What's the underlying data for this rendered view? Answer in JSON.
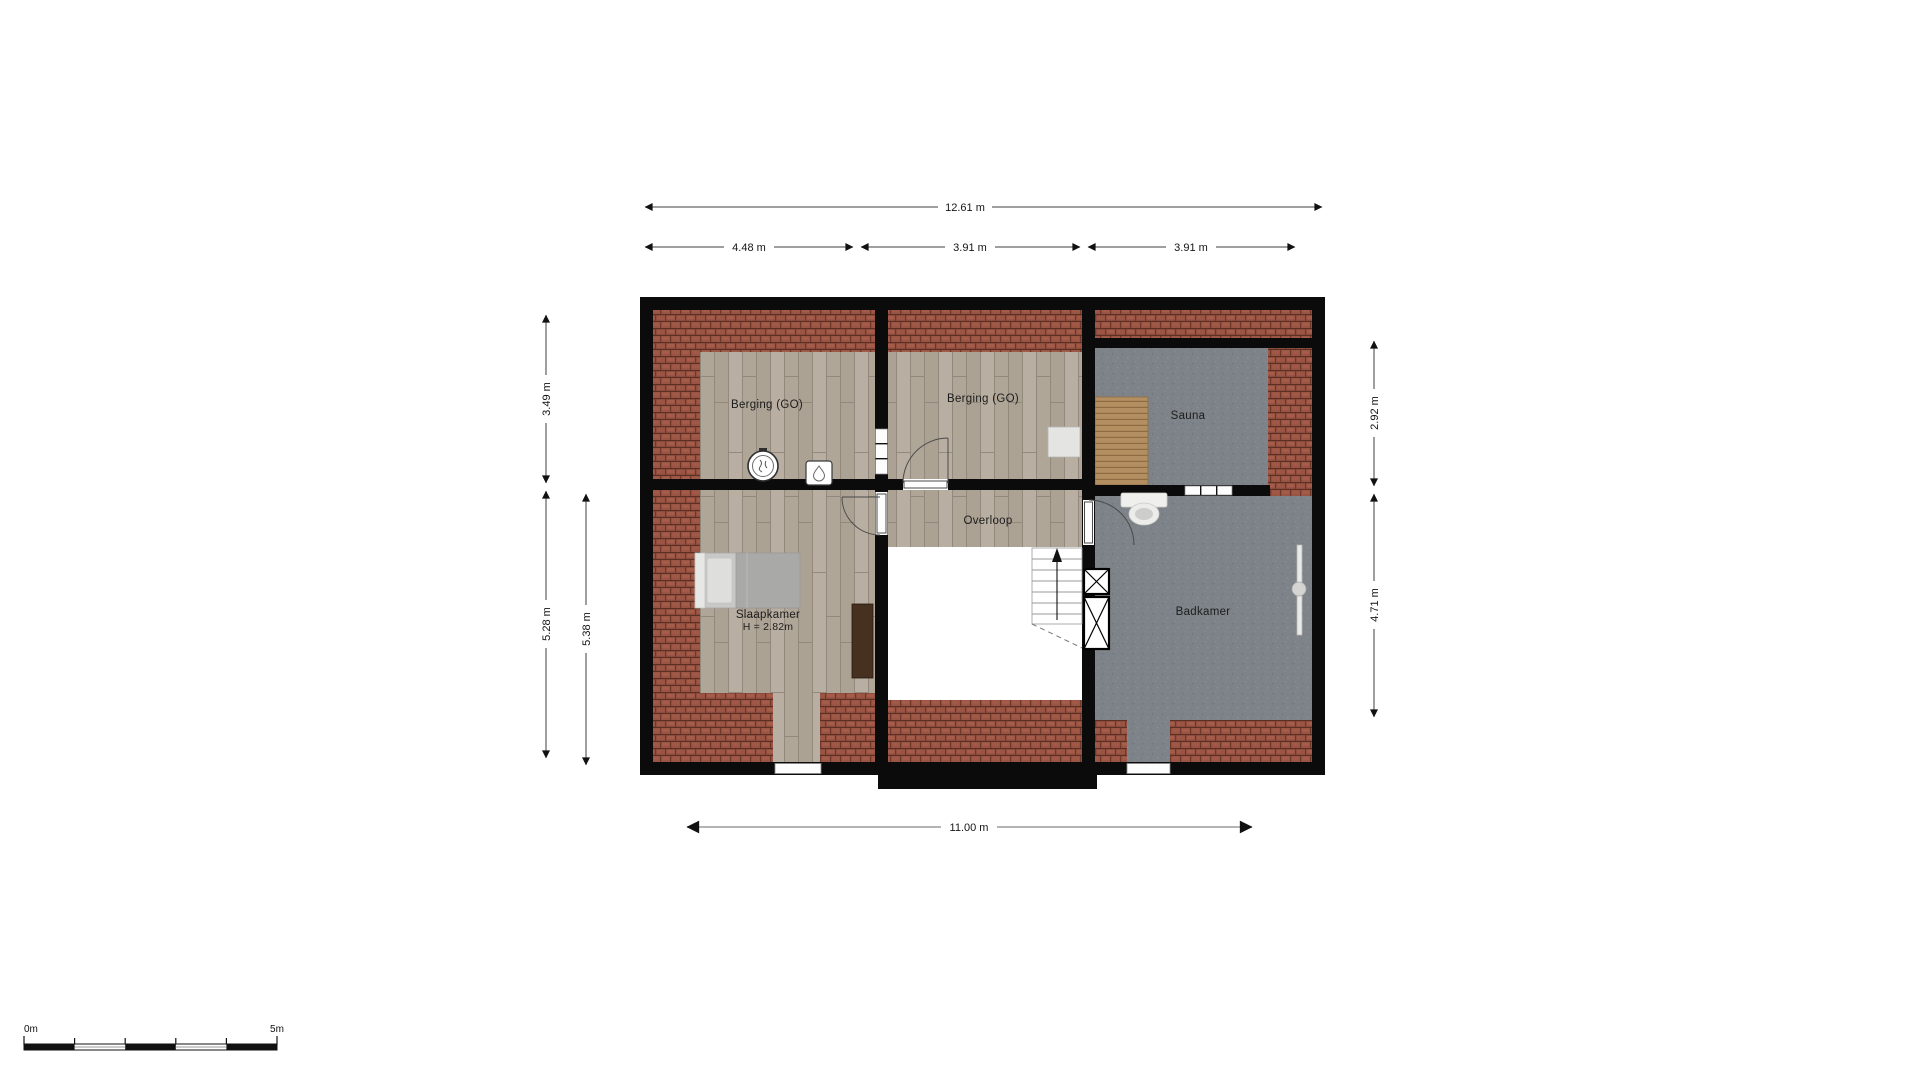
{
  "plan": {
    "rooms": {
      "berging_left": {
        "label": "Berging (GO)"
      },
      "berging_mid": {
        "label": "Berging (GO)"
      },
      "sauna": {
        "label": "Sauna"
      },
      "overloop": {
        "label": "Overloop"
      },
      "slaapkamer": {
        "label": "Slaapkamer",
        "height_note": "H = 2.82m"
      },
      "badkamer": {
        "label": "Badkamer"
      }
    },
    "dimensions": {
      "top_total": "12.61 m",
      "top_seg_1": "4.48 m",
      "top_seg_2": "3.91 m",
      "top_seg_3": "3.91 m",
      "left_upper": "3.49 m",
      "left_lower": "5.28 m",
      "left_inner": "5.38 m",
      "right_upper": "2.92 m",
      "right_lower": "4.71 m",
      "bottom_total": "11.00 m"
    },
    "scale_bar": {
      "start_label": "0m",
      "end_label": "5m"
    },
    "colors": {
      "wall": "#0b0b0b",
      "roof_tiles": "#9a5443",
      "wood_floor": "#b2a89b",
      "tile_floor_gray": "#7d8388",
      "sauna_bench": "#b38e60"
    }
  }
}
